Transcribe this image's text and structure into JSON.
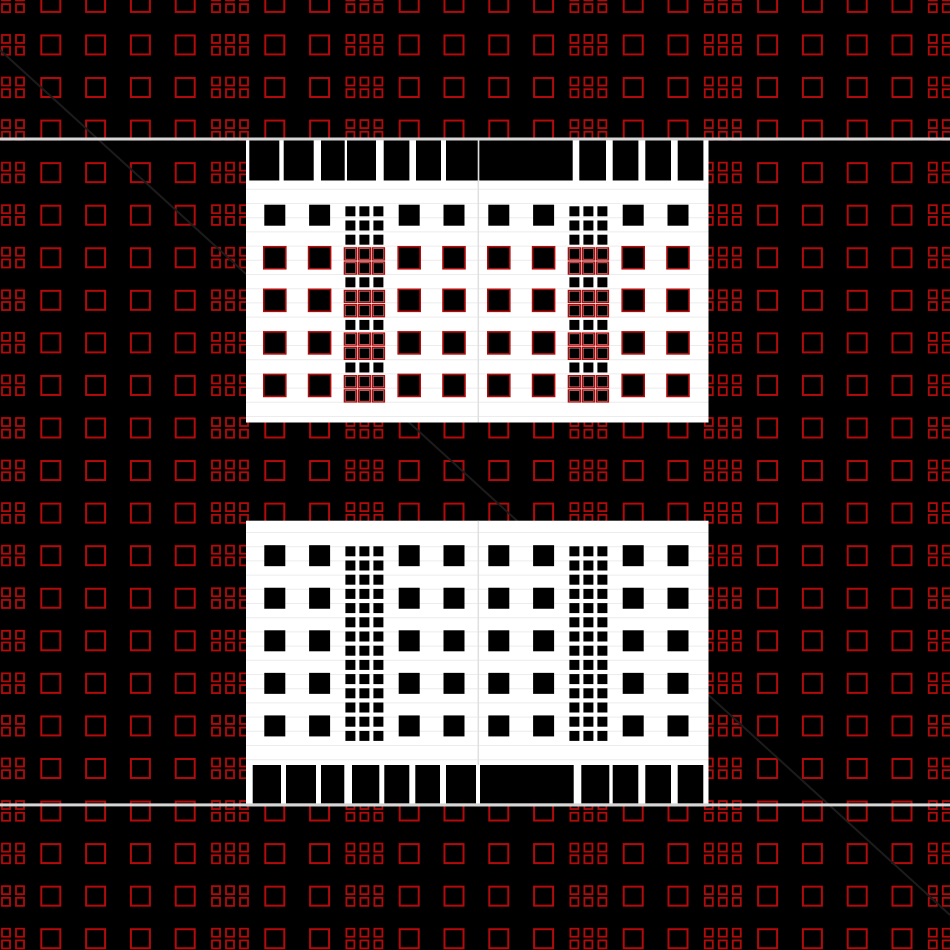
{
  "canvas": {
    "width": 950,
    "height": 950,
    "background": "#000000"
  },
  "palette": {
    "red": "#b30b0b",
    "panel_white": "#ffffff",
    "shape_black": "#000000",
    "divider_gray": "#d6d6d6",
    "rule_gray": "#ececec",
    "vline_gray": "#e0e0e0",
    "diagonal_gray": "#1c1c1c"
  },
  "background_grid": {
    "columns": 22,
    "rows": 23,
    "col_pitch": 44.8,
    "row_pitch": 42.56,
    "first_col_center_x": 6,
    "first_row_center_y": 2.4,
    "square_size": 19,
    "square_stroke": 2,
    "cluster_columns": [
      0,
      5,
      8,
      13,
      16,
      21
    ],
    "cluster": {
      "cols": 3,
      "pitch_x": 14,
      "small_size": 8,
      "small_stroke": 1.8,
      "row_top_offsets": [
        -10,
        1.7
      ]
    }
  },
  "diagonal_line": {
    "x1": 0,
    "y1": 50,
    "x2": 950,
    "y2": 915,
    "stroke_width": 2
  },
  "divider_lines": [
    {
      "y": 137.5,
      "thickness": 3
    },
    {
      "y": 803.4,
      "thickness": 3
    }
  ],
  "panels": [
    {
      "id": "top-panel",
      "x": 246,
      "y": 137.5,
      "width": 462.5,
      "height": 285,
      "bars": {
        "side": "top",
        "y": 140.5,
        "height": 40,
        "items": [
          [
            249.3,
            30
          ],
          [
            283.7,
            30
          ],
          [
            321,
            23.7
          ],
          [
            347,
            29
          ],
          [
            383.7,
            25.7
          ],
          [
            416,
            25
          ],
          [
            446,
            31.7
          ],
          [
            479.3,
            93.4
          ],
          [
            579.3,
            26.7
          ],
          [
            612.7,
            25.7
          ],
          [
            645.3,
            25.7
          ],
          [
            677.7,
            25.7
          ]
        ]
      },
      "square_rows": [
        5,
        6,
        7,
        8,
        9
      ],
      "square_cols": [
        6,
        7,
        9,
        10,
        11,
        12,
        14,
        15
      ],
      "square_size": 21,
      "strip_cols": [
        8,
        13
      ],
      "strip": {
        "start_y": 206.3,
        "pitch_y": 14.2,
        "count": 14,
        "size": 10,
        "pitch_x": 14
      },
      "red_overlay": {
        "rows": [
          6,
          7,
          8,
          9
        ],
        "strip_row_indices": [
          3,
          4,
          6,
          7,
          9,
          10,
          12,
          13
        ]
      },
      "rules": {
        "start_y": 189.3,
        "pitch_y": 14.2,
        "count": 17
      },
      "vline": {
        "x": 478.3,
        "y1": 140.5,
        "y2": 422.5
      }
    },
    {
      "id": "bottom-panel",
      "x": 246,
      "y": 520.7,
      "width": 462.5,
      "height": 285.7,
      "bars": {
        "side": "bottom",
        "y": 765,
        "height": 38.4,
        "items": [
          [
            252.7,
            28.3
          ],
          [
            286,
            30
          ],
          [
            321,
            23.3
          ],
          [
            352,
            27.3
          ],
          [
            384.3,
            25
          ],
          [
            415.3,
            24.7
          ],
          [
            446,
            30
          ],
          [
            480,
            93.7
          ],
          [
            581.3,
            28
          ],
          [
            612.7,
            25.6
          ],
          [
            645.3,
            25.7
          ],
          [
            677.7,
            25.6
          ]
        ]
      },
      "square_rows": [
        13,
        14,
        15,
        16,
        17
      ],
      "square_cols": [
        6,
        7,
        9,
        10,
        11,
        12,
        14,
        15
      ],
      "square_size": 21,
      "strip_cols": [
        8,
        13
      ],
      "strip": {
        "start_y": 546.3,
        "pitch_y": 14.2,
        "count": 14,
        "size": 10,
        "pitch_x": 14
      },
      "red_overlay": null,
      "rules": {
        "start_y": 532.5,
        "pitch_y": 14.2,
        "count": 17
      },
      "vline": {
        "x": 478.3,
        "y1": 520.7,
        "y2": 765
      }
    }
  ]
}
